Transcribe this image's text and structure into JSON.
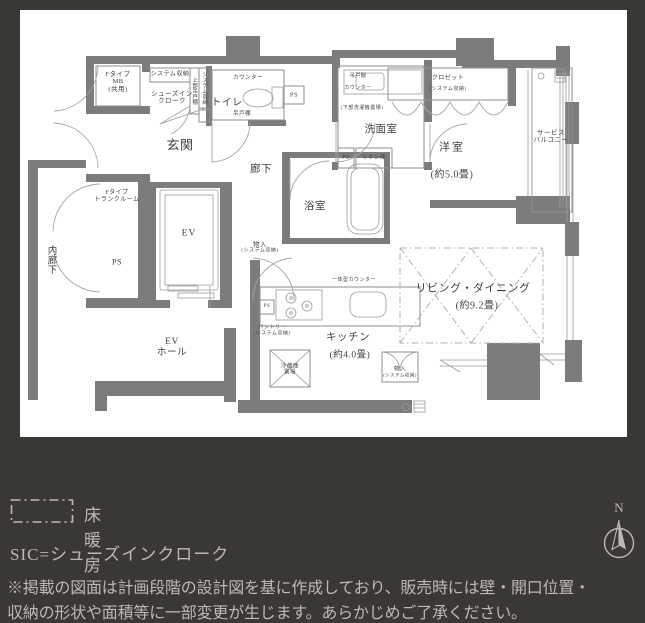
{
  "colors": {
    "background": "#3a3835",
    "panel": "#ffffff",
    "wall": "#7c7c7c",
    "line": "#8e8e8e",
    "plan_text": "#453f42",
    "legend_text": "#beb8b1"
  },
  "plan": {
    "mb1": "Fタイプ",
    "mb2": "MB",
    "mb3": "(共用)",
    "sys_storage": "システム収納",
    "sic1": "シューズイン",
    "sic2": "クローク",
    "upper_shelf": "上部吊戸棚",
    "sys_storage_v": "システム収納",
    "genkan": "玄関",
    "toilet": "トイレ",
    "counter": "カウンター",
    "hanging": "吊戸棚",
    "ps": "PS",
    "washroom": "洗面室",
    "washer_note": "(下部洗濯機置場)",
    "linen": "リネン庫",
    "bath": "浴室",
    "hallway": "廊下",
    "monoire": "物入",
    "sys_storage_paren": "(システム収納)",
    "ev": "EV",
    "ev_hall1": "EV",
    "ev_hall2": "ホール",
    "trunk1": "Fタイプ",
    "trunk2": "トランクルーム",
    "inner_corridor": "内廊下",
    "kitchen": "キッチン",
    "kitchen_size": "(約4.0畳)",
    "pantry": "パントリー",
    "fridge1": "冷蔵庫",
    "fridge2": "置場",
    "integrated_counter": "一体型カウンター",
    "living": "リビング・ダイニング",
    "living_size": "(約9.2畳)",
    "bedroom": "洋室",
    "bedroom_size": "(約5.0畳)",
    "closet": "クロゼット",
    "closet_sub": "(システム収納)",
    "balcony1": "サービス",
    "balcony2": "バルコニー"
  },
  "legend": {
    "floor_heating": "床暖房",
    "sic": "SIC=シューズインクローク",
    "note_line1": "※掲載の図面は計画段階の設計図を基に作成しており、販売時には壁・開口位置・",
    "note_line2": "収納の形状や面積等に一部変更が生じます。あらかじめご了承ください。",
    "compass_n": "N"
  }
}
